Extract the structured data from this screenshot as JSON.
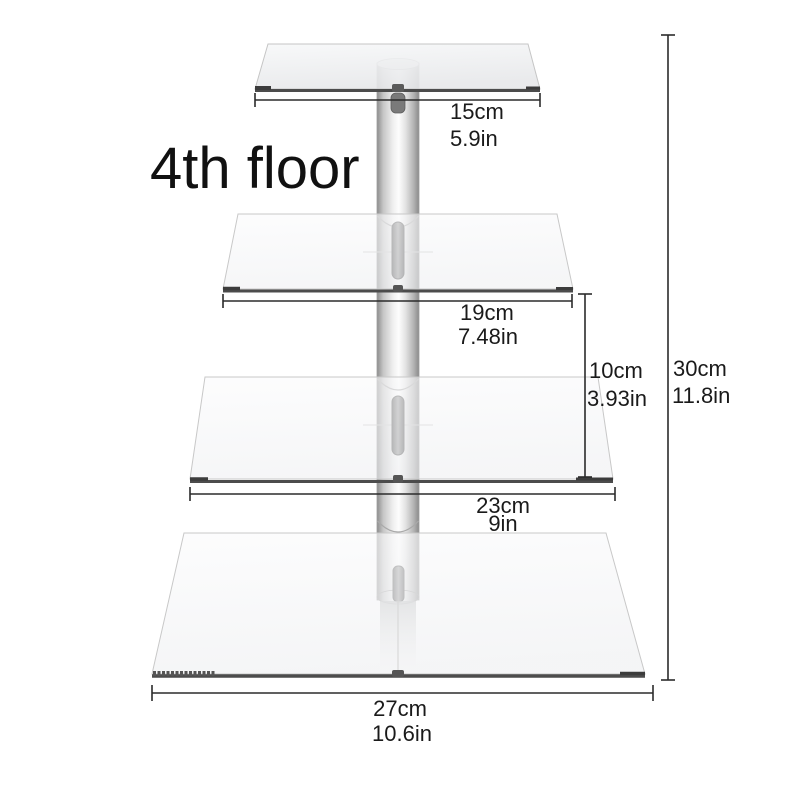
{
  "title": "4th floor",
  "colors": {
    "background": "#ffffff",
    "text": "#1a1a1a",
    "dimension_line": "#2b2b2b",
    "plate_edge": "#4c4c4c",
    "pole_silver": "#c6c6c6"
  },
  "dimensions": {
    "tier1_width": {
      "cm": "15cm",
      "inch": "5.9in"
    },
    "tier2_width": {
      "cm": "19cm",
      "inch": "7.48in"
    },
    "tier_spacing": {
      "cm": "10cm",
      "inch": "3.93in"
    },
    "tier3_width": {
      "cm": "23cm",
      "inch": "9in"
    },
    "base_width": {
      "cm": "27cm",
      "inch": "10.6in"
    },
    "total_height": {
      "cm": "30cm",
      "inch": "11.8in"
    }
  }
}
